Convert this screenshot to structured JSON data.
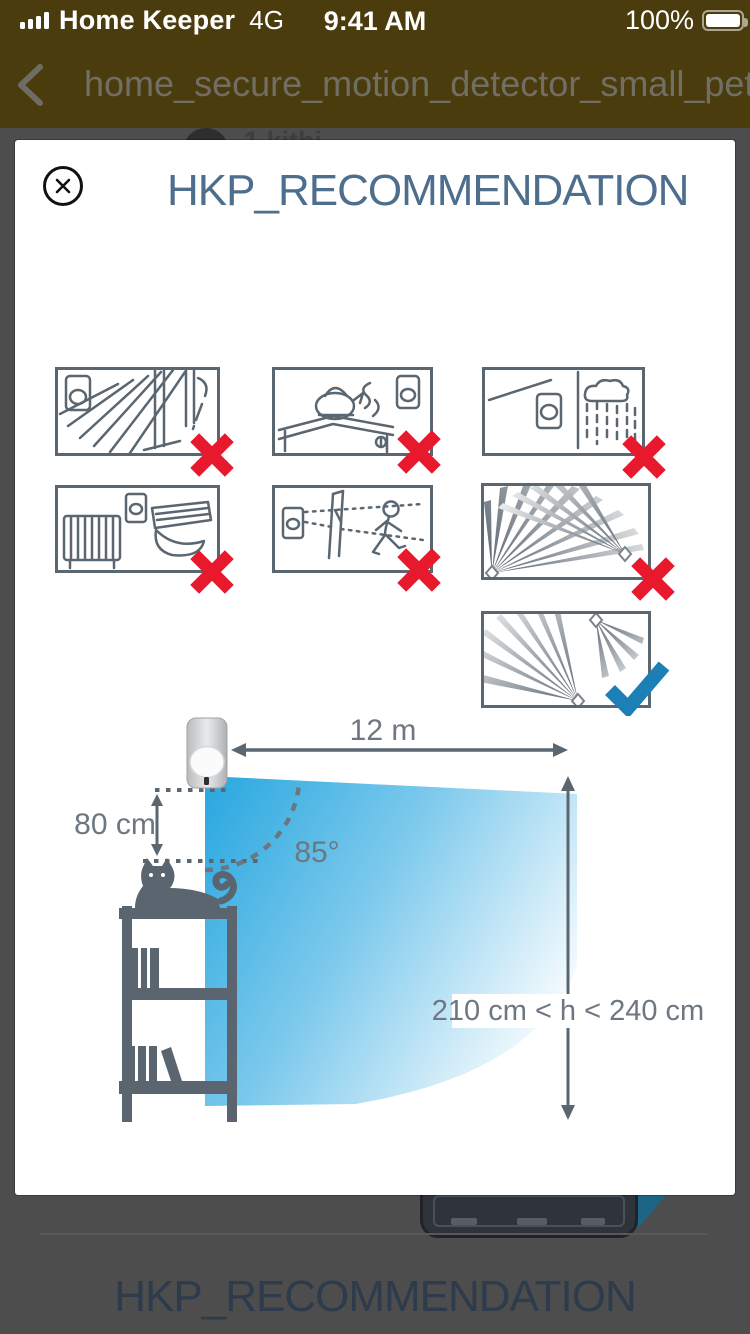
{
  "status_bar": {
    "signal_icon": "signal-bars-full",
    "carrier": "Home Keeper",
    "network": "4G",
    "time": "9:41 AM",
    "battery_percent": "100%",
    "battery_icon": "battery-full"
  },
  "nav_bar": {
    "back_icon": "chevron-left",
    "title": "home_secure_motion_detector_small_pet"
  },
  "background_page": {
    "partial_list_text": "1 kithi",
    "bottom_title": "HKP_RECOMMENDATION"
  },
  "modal": {
    "close_icon": "circle-x",
    "title": "HKP_RECOMMENDATION",
    "placement_guidelines": [
      {
        "icon": "detector-window-direct-sunlight",
        "verdict": "cross"
      },
      {
        "icon": "detector-kettle-steam",
        "verdict": "cross"
      },
      {
        "icon": "detector-outdoor-rain",
        "verdict": "cross"
      },
      {
        "icon": "detector-radiator-air-conditioner",
        "verdict": "cross"
      },
      {
        "icon": "detector-wall-obstruction-person",
        "verdict": "cross"
      },
      {
        "icon": "detectors-facing-overlapping-beams",
        "verdict": "cross"
      },
      {
        "icon": "detectors-non-overlapping-beams",
        "verdict": "check"
      }
    ],
    "diagram": {
      "range_label": "12 m",
      "offset_label": "80 cm",
      "angle_label": "85°",
      "height_label": "210 cm < h < 240 cm"
    }
  },
  "colors": {
    "cross_red": "#E8192C",
    "check_blue": "#1C7FB5",
    "cone_blue": "#2AA8E0",
    "title_blue": "#4E6E8E",
    "line_grey": "#5A6670",
    "header_olive": "#4B3C0E"
  }
}
